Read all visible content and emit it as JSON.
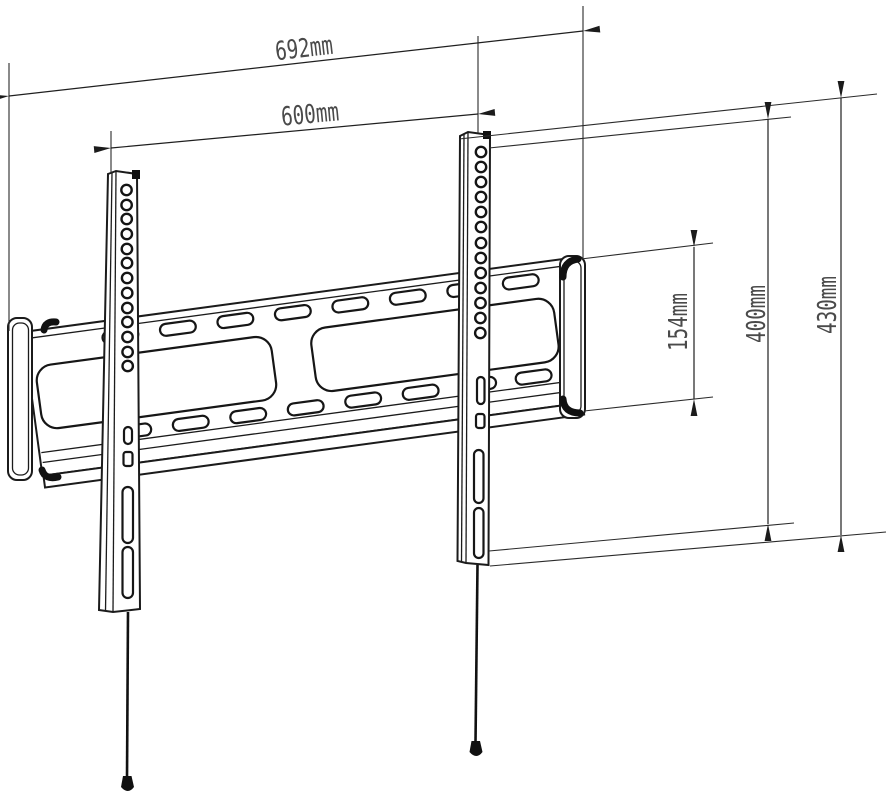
{
  "page": {
    "background_color": "#ffffff",
    "line_color": "#1b1b1b",
    "label_color": "#4a4a4a"
  },
  "diagram": {
    "kind": "technical dimension drawing",
    "subject": "fixed TV wall mount bracket (wall plate with two VESA rails)",
    "dims": {
      "overall_width": "692mm",
      "rail_spacing": "600mm",
      "plate_height": "154mm",
      "hole_span_vertical": "400mm",
      "rail_height": "430mm"
    },
    "features": {
      "vesa_holes_per_rail": 13,
      "plate_slots_per_row": 8,
      "window_cutouts": 2,
      "pull_cords": 2
    }
  }
}
